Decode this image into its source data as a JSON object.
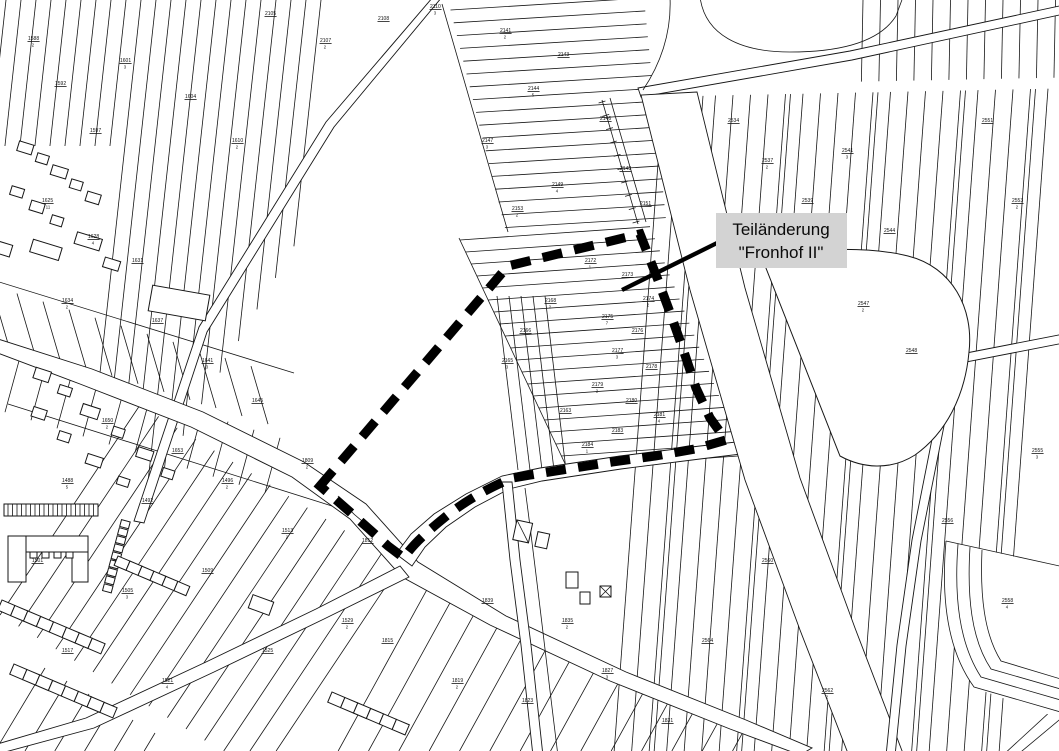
{
  "annotation": {
    "line1": "Teiländerung",
    "line2": "\"Fronhof II\"",
    "target_area": "Fronhof II"
  },
  "colors": {
    "background": "#ffffff",
    "map_lines": "#161616",
    "boundary": "#000000",
    "label_box_bg": "#d3d3d3",
    "label_text": "#0a0a0a"
  },
  "parcel_labels": [
    {
      "x": 265,
      "y": 15,
      "num": "2105",
      "den": ""
    },
    {
      "x": 320,
      "y": 42,
      "num": "2107",
      "den": "2"
    },
    {
      "x": 378,
      "y": 20,
      "num": "2108",
      "den": ""
    },
    {
      "x": 430,
      "y": 8,
      "num": "2110",
      "den": "3"
    },
    {
      "x": 55,
      "y": 85,
      "num": "1592",
      "den": ""
    },
    {
      "x": 120,
      "y": 62,
      "num": "1601",
      "den": "3"
    },
    {
      "x": 185,
      "y": 98,
      "num": "1604",
      "den": ""
    },
    {
      "x": 232,
      "y": 142,
      "num": "1610",
      "den": "2"
    },
    {
      "x": 90,
      "y": 132,
      "num": "1597",
      "den": ""
    },
    {
      "x": 28,
      "y": 40,
      "num": "1588",
      "den": "2"
    },
    {
      "x": 500,
      "y": 32,
      "num": "2141",
      "den": "2"
    },
    {
      "x": 558,
      "y": 56,
      "num": "2143",
      "den": ""
    },
    {
      "x": 528,
      "y": 90,
      "num": "2144",
      "den": "5"
    },
    {
      "x": 600,
      "y": 120,
      "num": "2146",
      "den": ""
    },
    {
      "x": 482,
      "y": 142,
      "num": "2147",
      "den": "3"
    },
    {
      "x": 620,
      "y": 170,
      "num": "2148",
      "den": ""
    },
    {
      "x": 552,
      "y": 186,
      "num": "2149",
      "den": "4"
    },
    {
      "x": 640,
      "y": 205,
      "num": "2151",
      "den": ""
    },
    {
      "x": 512,
      "y": 210,
      "num": "2153",
      "den": "2"
    },
    {
      "x": 585,
      "y": 262,
      "num": "2172",
      "den": "1"
    },
    {
      "x": 622,
      "y": 276,
      "num": "2173",
      "den": ""
    },
    {
      "x": 643,
      "y": 300,
      "num": "2174",
      "den": "2"
    },
    {
      "x": 602,
      "y": 318,
      "num": "2175",
      "den": "7"
    },
    {
      "x": 632,
      "y": 332,
      "num": "2176",
      "den": ""
    },
    {
      "x": 612,
      "y": 352,
      "num": "2177",
      "den": "3"
    },
    {
      "x": 646,
      "y": 368,
      "num": "2178",
      "den": ""
    },
    {
      "x": 592,
      "y": 386,
      "num": "2179",
      "den": "2"
    },
    {
      "x": 626,
      "y": 402,
      "num": "2180",
      "den": ""
    },
    {
      "x": 654,
      "y": 416,
      "num": "2181",
      "den": "4"
    },
    {
      "x": 612,
      "y": 432,
      "num": "2183",
      "den": ""
    },
    {
      "x": 582,
      "y": 446,
      "num": "2184",
      "den": "1"
    },
    {
      "x": 545,
      "y": 302,
      "num": "2168",
      "den": "2"
    },
    {
      "x": 520,
      "y": 332,
      "num": "2166",
      "den": ""
    },
    {
      "x": 502,
      "y": 362,
      "num": "2165",
      "den": "3"
    },
    {
      "x": 560,
      "y": 412,
      "num": "2163",
      "den": ""
    },
    {
      "x": 728,
      "y": 122,
      "num": "2534",
      "den": ""
    },
    {
      "x": 762,
      "y": 162,
      "num": "2537",
      "den": "2"
    },
    {
      "x": 802,
      "y": 202,
      "num": "2539",
      "den": ""
    },
    {
      "x": 842,
      "y": 152,
      "num": "2541",
      "den": "3"
    },
    {
      "x": 884,
      "y": 232,
      "num": "2544",
      "den": ""
    },
    {
      "x": 858,
      "y": 305,
      "num": "2547",
      "den": "2"
    },
    {
      "x": 906,
      "y": 352,
      "num": "2548",
      "den": ""
    },
    {
      "x": 982,
      "y": 122,
      "num": "2551",
      "den": ""
    },
    {
      "x": 1012,
      "y": 202,
      "num": "2553",
      "den": "2"
    },
    {
      "x": 942,
      "y": 522,
      "num": "2556",
      "den": ""
    },
    {
      "x": 1002,
      "y": 602,
      "num": "2558",
      "den": "4"
    },
    {
      "x": 762,
      "y": 562,
      "num": "2560",
      "den": ""
    },
    {
      "x": 822,
      "y": 692,
      "num": "2562",
      "den": "2"
    },
    {
      "x": 702,
      "y": 642,
      "num": "2564",
      "den": ""
    },
    {
      "x": 1032,
      "y": 452,
      "num": "2555",
      "den": "3"
    },
    {
      "x": 42,
      "y": 202,
      "num": "1625",
      "den": "11"
    },
    {
      "x": 88,
      "y": 238,
      "num": "1628",
      "den": "4"
    },
    {
      "x": 132,
      "y": 262,
      "num": "1631",
      "den": ""
    },
    {
      "x": 62,
      "y": 302,
      "num": "1634",
      "den": "2"
    },
    {
      "x": 152,
      "y": 322,
      "num": "1637",
      "den": ""
    },
    {
      "x": 202,
      "y": 362,
      "num": "1641",
      "den": "3"
    },
    {
      "x": 252,
      "y": 402,
      "num": "1645",
      "den": ""
    },
    {
      "x": 102,
      "y": 422,
      "num": "1650",
      "den": "2"
    },
    {
      "x": 172,
      "y": 452,
      "num": "1653",
      "den": ""
    },
    {
      "x": 62,
      "y": 482,
      "num": "1488",
      "den": "5"
    },
    {
      "x": 142,
      "y": 502,
      "num": "1492",
      "den": ""
    },
    {
      "x": 222,
      "y": 482,
      "num": "1496",
      "den": "2"
    },
    {
      "x": 32,
      "y": 562,
      "num": "1501",
      "den": ""
    },
    {
      "x": 122,
      "y": 592,
      "num": "1505",
      "den": "3"
    },
    {
      "x": 202,
      "y": 572,
      "num": "1509",
      "den": ""
    },
    {
      "x": 282,
      "y": 532,
      "num": "1513",
      "den": "2"
    },
    {
      "x": 62,
      "y": 652,
      "num": "1517",
      "den": ""
    },
    {
      "x": 162,
      "y": 682,
      "num": "1521",
      "den": "4"
    },
    {
      "x": 262,
      "y": 652,
      "num": "1525",
      "den": ""
    },
    {
      "x": 342,
      "y": 622,
      "num": "1529",
      "den": "2"
    },
    {
      "x": 382,
      "y": 642,
      "num": "1815",
      "den": ""
    },
    {
      "x": 452,
      "y": 682,
      "num": "1819",
      "den": "2"
    },
    {
      "x": 522,
      "y": 702,
      "num": "1823",
      "den": ""
    },
    {
      "x": 602,
      "y": 672,
      "num": "1827",
      "den": "3"
    },
    {
      "x": 662,
      "y": 722,
      "num": "1831",
      "den": ""
    },
    {
      "x": 562,
      "y": 622,
      "num": "1835",
      "den": "2"
    },
    {
      "x": 482,
      "y": 602,
      "num": "1839",
      "den": ""
    },
    {
      "x": 302,
      "y": 462,
      "num": "1809",
      "den": "2"
    },
    {
      "x": 362,
      "y": 542,
      "num": "1812",
      "den": ""
    }
  ]
}
